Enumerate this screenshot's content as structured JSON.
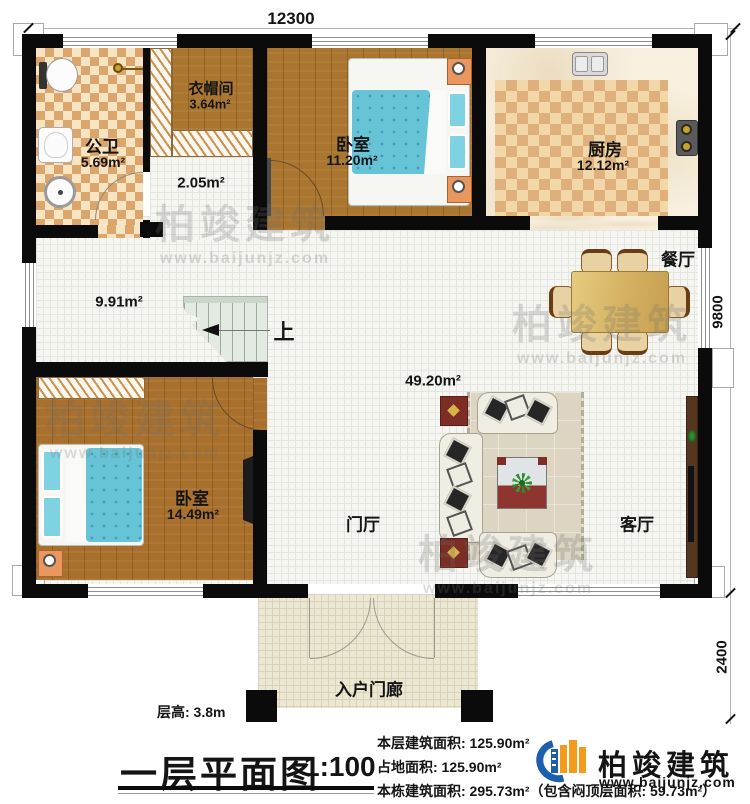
{
  "plan": {
    "dimensions": {
      "top": "12300",
      "right_upper": "9800",
      "right_lower": "2400"
    },
    "rooms": {
      "bathroom": {
        "name": "公卫",
        "area": "5.69m²"
      },
      "cloakroom": {
        "name": "衣帽间",
        "area": "3.64m²"
      },
      "hallway": {
        "area": "2.05m²"
      },
      "bedroom1": {
        "name": "卧室",
        "area": "11.20m²"
      },
      "kitchen": {
        "name": "厨房",
        "area": "12.12m²"
      },
      "dining": {
        "name": "餐厅"
      },
      "corridor": {
        "area": "9.91m²"
      },
      "living_zone": {
        "area": "49.20m²"
      },
      "bedroom2": {
        "name": "卧室",
        "area": "14.49m²"
      },
      "foyer": {
        "name": "门厅"
      },
      "living": {
        "name": "客厅"
      },
      "porch": {
        "name": "入户门廊"
      },
      "stairs": {
        "direction": "上"
      }
    }
  },
  "annotations": {
    "floor_height": "层高: 3.8m",
    "title": "一层平面图",
    "scale": "1:100",
    "floor_area_label": "本层建筑面积: 125.90m²",
    "land_area_label": "占地面积: 125.90m²",
    "building_area_label": "本栋建筑面积: 295.73m²",
    "building_area_note": "（包含闷顶层面积: 59.73m²）"
  },
  "branding": {
    "company": "柏竣建筑",
    "website": "www.baijunjz.com"
  },
  "watermark": {
    "company": "柏竣建筑",
    "website": "www.baijunjz.com"
  },
  "colors": {
    "wall": "#0b0b0b",
    "wood": "#a9752f",
    "checker": "#dca56c",
    "logo_blue": "#1b5fae",
    "logo_orange": "#f59b1b",
    "bed_blue": "#66c4d6"
  }
}
